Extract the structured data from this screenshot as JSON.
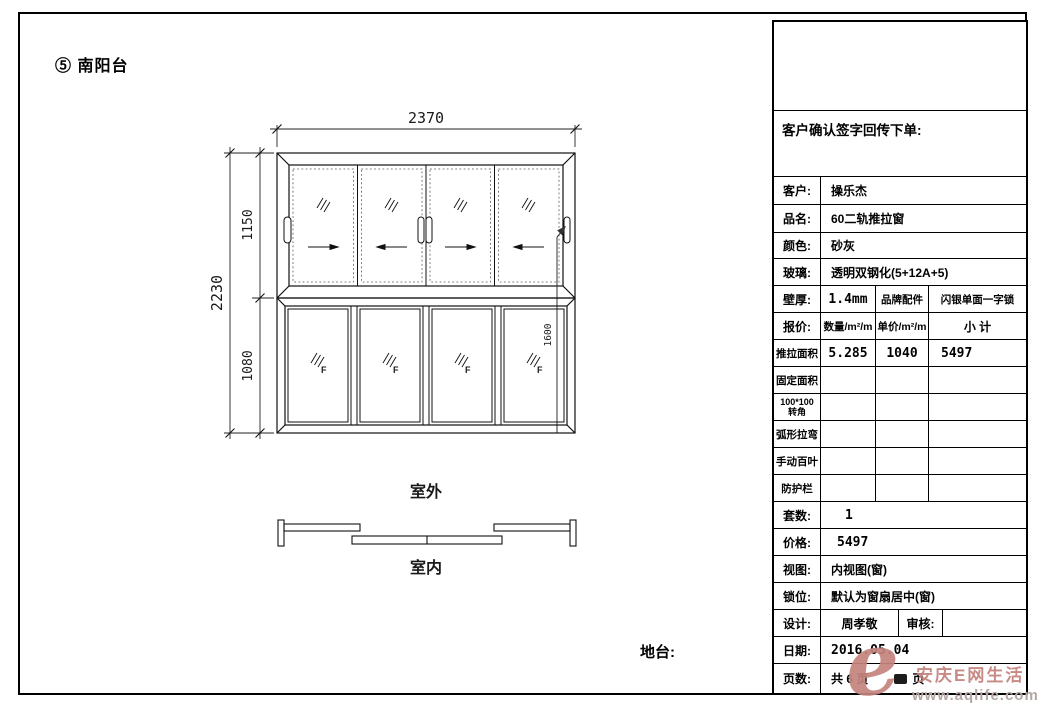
{
  "sheet": {
    "title": "⑤ 南阳台",
    "floor_label": "地台:"
  },
  "drawing": {
    "dims": {
      "width": "2370",
      "total_height": "2230",
      "top_height": "1150",
      "bottom_height": "1080",
      "handle_height": "1600"
    },
    "labels": {
      "outdoor": "室外",
      "indoor": "室内",
      "fixed": "F"
    }
  },
  "table": {
    "header": "客户确认签字回传下单:",
    "customer_label": "客户:",
    "customer": "操乐杰",
    "product_label": "品名:",
    "product": "60二轨推拉窗",
    "color_label": "颜色:",
    "color": "砂灰",
    "glass_label": "玻璃:",
    "glass": "透明双钢化(5+12A+5)",
    "wall_label": "壁厚:",
    "wall": "1.4mm",
    "brand_label": "品牌配件",
    "brand": "闪银单面一字锁",
    "quote_label": "报价:",
    "qty_header": "数量/m²/m",
    "price_header": "单价/m²/m",
    "subtotal_header": "小 计",
    "row_sliding": {
      "label": "推拉面积",
      "qty": "5.285",
      "price": "1040",
      "subtotal": "5497"
    },
    "row_fixed": {
      "label": "固定面积"
    },
    "row_corner": {
      "label_line1": "100*100",
      "label_line2": "转角"
    },
    "row_arc": {
      "label": "弧形拉弯"
    },
    "row_blind": {
      "label": "手动百叶"
    },
    "row_guard": {
      "label": "防护栏"
    },
    "sets_label": "套数:",
    "sets": "1",
    "price_label": "价格:",
    "price": "5497",
    "view_label": "视图:",
    "view": "内视图(窗)",
    "lock_label": "锁位:",
    "lock": "默认为窗扇居中(窗)",
    "design_label": "设计:",
    "designer": "周孝敬",
    "review_label": "审核:",
    "date_label": "日期:",
    "date": "2016.05.04",
    "pages_label": "页数:",
    "pages_total": "共 6 页",
    "pages_suffix": "页"
  },
  "watermark": {
    "logo_text": "e",
    "site_name": "安庆E网生活",
    "site_url": "www.aqlife.com",
    "accent_color": "#c5847e"
  }
}
